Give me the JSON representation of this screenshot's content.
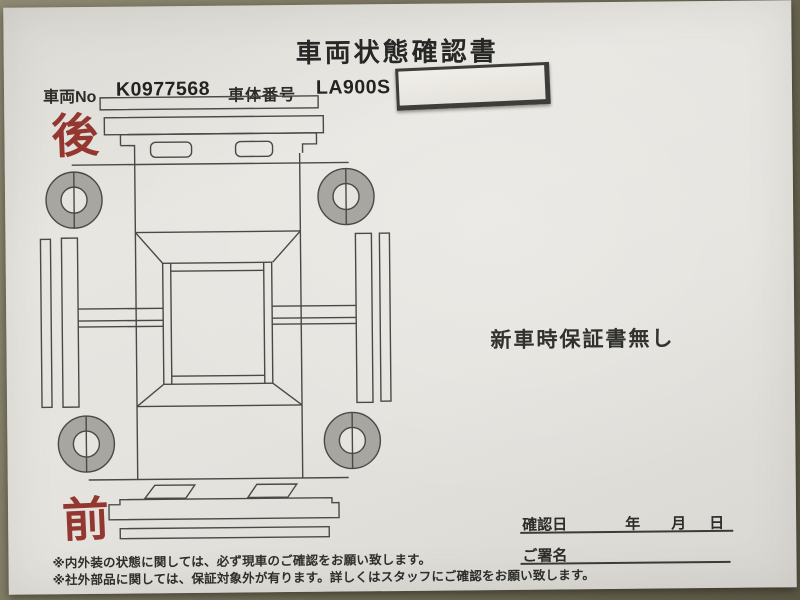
{
  "photo": {
    "title": "車両状態確認書",
    "header": {
      "vehicle_no_label": "車両No",
      "vehicle_no_value": "K0977568",
      "body_no_label": "車体番号",
      "body_no_value": "LA900S"
    },
    "markers": {
      "rear": "後",
      "front": "前"
    },
    "warranty_note": "新車時保証書無し",
    "confirm": {
      "date_label": "確認日",
      "year": "年",
      "month": "月",
      "day": "日",
      "signature_label": "ご署名"
    },
    "footnotes": {
      "note1": "※内外装の状態に関しては、必ず現車のご確認をお願い致します。",
      "note2": "※社外部品に関しては、保証対象外が有ります。詳しくはスタッフにご確認をお願い致します。"
    },
    "colors": {
      "accent_red": "#943730",
      "paper": "#e6e4df",
      "desk": "#6e6a56",
      "diagram_line": "#4a4947",
      "wheel_fill": "#a8a6a1"
    },
    "diagram": "car-top-view"
  }
}
